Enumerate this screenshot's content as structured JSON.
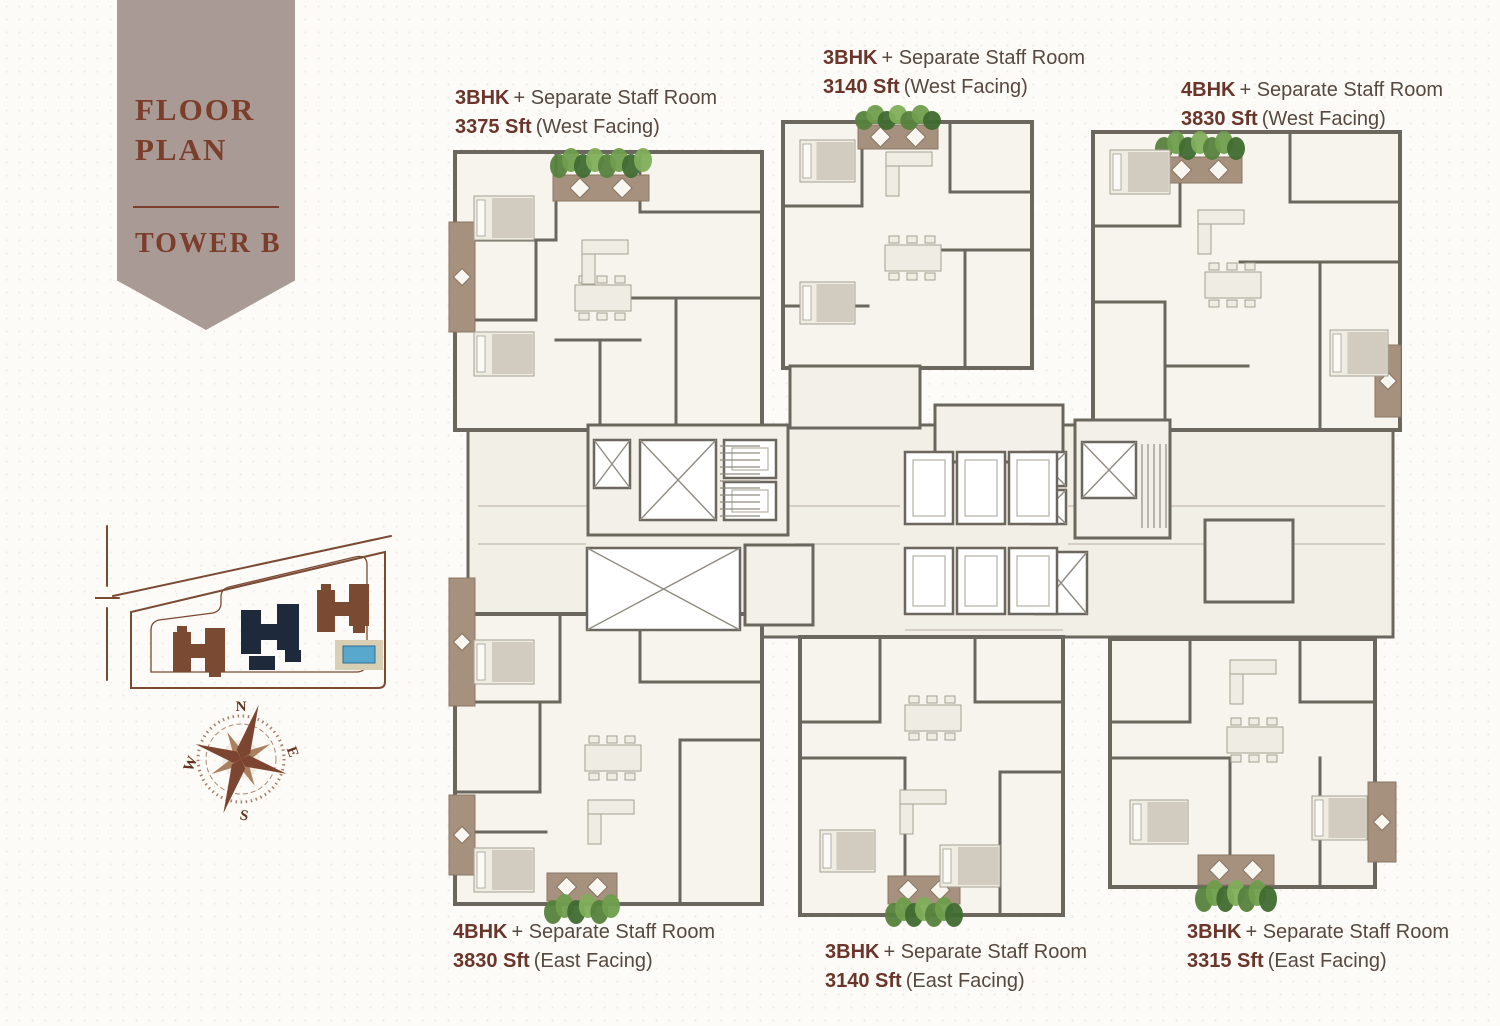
{
  "banner": {
    "title_line1": "FLOOR",
    "title_line2": "PLAN",
    "tower": "TOWER B"
  },
  "units": [
    {
      "id": "top-left",
      "bhk": "3BHK",
      "suffix": "+ Separate Staff Room",
      "area": "3375 Sft",
      "facing": "(West Facing)"
    },
    {
      "id": "top-middle",
      "bhk": "3BHK",
      "suffix": "+ Separate Staff Room",
      "area": "3140 Sft",
      "facing": "(West Facing)"
    },
    {
      "id": "top-right",
      "bhk": "4BHK",
      "suffix": "+ Separate Staff Room",
      "area": "3830 Sft",
      "facing": "(West Facing)"
    },
    {
      "id": "bottom-left",
      "bhk": "4BHK",
      "suffix": "+ Separate Staff Room",
      "area": "3830 Sft",
      "facing": "(East Facing)"
    },
    {
      "id": "bottom-middle",
      "bhk": "3BHK",
      "suffix": "+ Separate Staff Room",
      "area": "3140 Sft",
      "facing": "(East Facing)"
    },
    {
      "id": "bottom-right",
      "bhk": "3BHK",
      "suffix": "+ Separate Staff Room",
      "area": "3315 Sft",
      "facing": "(East Facing)"
    }
  ],
  "compass": {
    "north": "N",
    "east": "E",
    "south": "S",
    "west": "W"
  },
  "colors": {
    "background": "#fcfbf7",
    "banner_bg": "#a99a96",
    "banner_text": "#7b3e2b",
    "label_bold": "#6a352a",
    "label_text": "#574840",
    "wall": "#6b675f",
    "floor": "#f7f4ee",
    "balcony_deck": "#a6917e",
    "plant_green": "#56823d",
    "site_outline_brown": "#7a4a33",
    "highlight_tower_navy": "#1e2a3b",
    "pool_blue": "#57a8cc"
  }
}
